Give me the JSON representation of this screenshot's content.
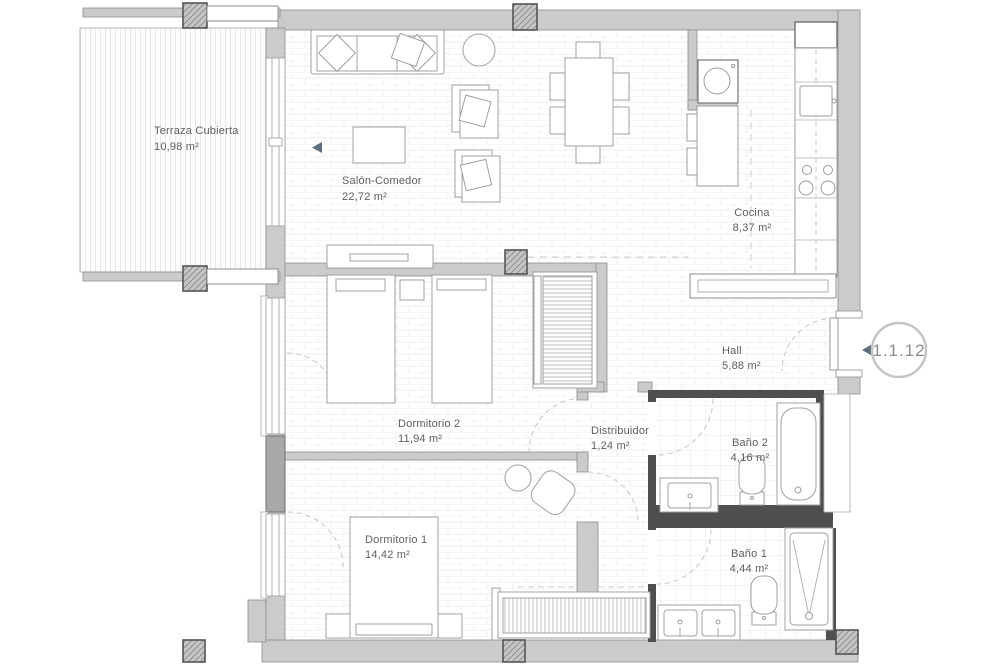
{
  "plan": {
    "unit_label": "1.1.12",
    "rooms": [
      {
        "id": "terraza",
        "name": "Terraza Cubierta",
        "area": "10,98 m²"
      },
      {
        "id": "salon",
        "name": "Salón-Comedor",
        "area": "22,72 m²"
      },
      {
        "id": "cocina",
        "name": "Cocina",
        "area": "8,37 m²"
      },
      {
        "id": "hall",
        "name": "Hall",
        "area": "5,88 m²"
      },
      {
        "id": "dormitorio2",
        "name": "Dormitorio 2",
        "area": "11,94 m²"
      },
      {
        "id": "distribuidor",
        "name": "Distribuidor",
        "area": "1,24 m²"
      },
      {
        "id": "bano2",
        "name": "Baño 2",
        "area": "4,16 m²"
      },
      {
        "id": "dormitorio1",
        "name": "Dormitorio 1",
        "area": "14,42 m²"
      },
      {
        "id": "bano1",
        "name": "Baño 1",
        "area": "4,44 m²"
      }
    ],
    "colors": {
      "wall": "#cbcbcb",
      "wall_dark": "#4f4f4f",
      "marker_accent": "#5d6e7e",
      "label_text": "#5f5f5f"
    }
  }
}
